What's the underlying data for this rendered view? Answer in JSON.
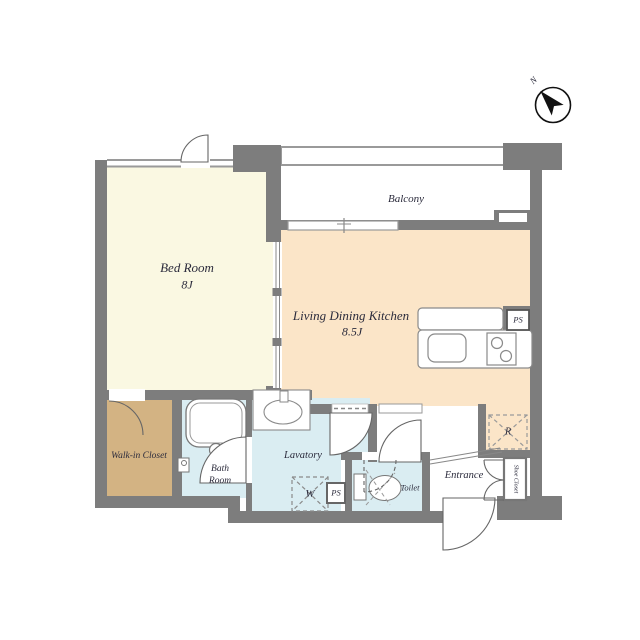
{
  "compass": {
    "north": "N"
  },
  "rooms": {
    "bed_room": {
      "label": "Bed Room",
      "size": "8J"
    },
    "ldk": {
      "label": "Living Dining Kitchen",
      "size": "8.5J"
    },
    "balcony": {
      "label": "Balcony"
    },
    "walk_in_closet": {
      "label": "Walk-in Closet"
    },
    "bath_room": {
      "label_line1": "Bath",
      "label_line2": "Room"
    },
    "lavatory": {
      "label": "Lavatory"
    },
    "toilet": {
      "label": "Toilet"
    },
    "entrance": {
      "label": "Entrance"
    },
    "shoe_closet": {
      "label": "Shoe Closet"
    }
  },
  "fixtures": {
    "washing_machine": {
      "label": "W"
    },
    "refrigerator": {
      "label": "R"
    },
    "pipe_space_kitchen": {
      "label": "PS"
    },
    "pipe_space_lavatory": {
      "label": "PS"
    }
  },
  "colors": {
    "wall": "#7d7d7d",
    "bed_room_floor": "#faf8e2",
    "ldk_floor": "#fbe5c8",
    "walk_in_closet_floor": "#d3b383",
    "wet_area_floor": "#daedf2",
    "label_text": "#2b2b3c"
  }
}
